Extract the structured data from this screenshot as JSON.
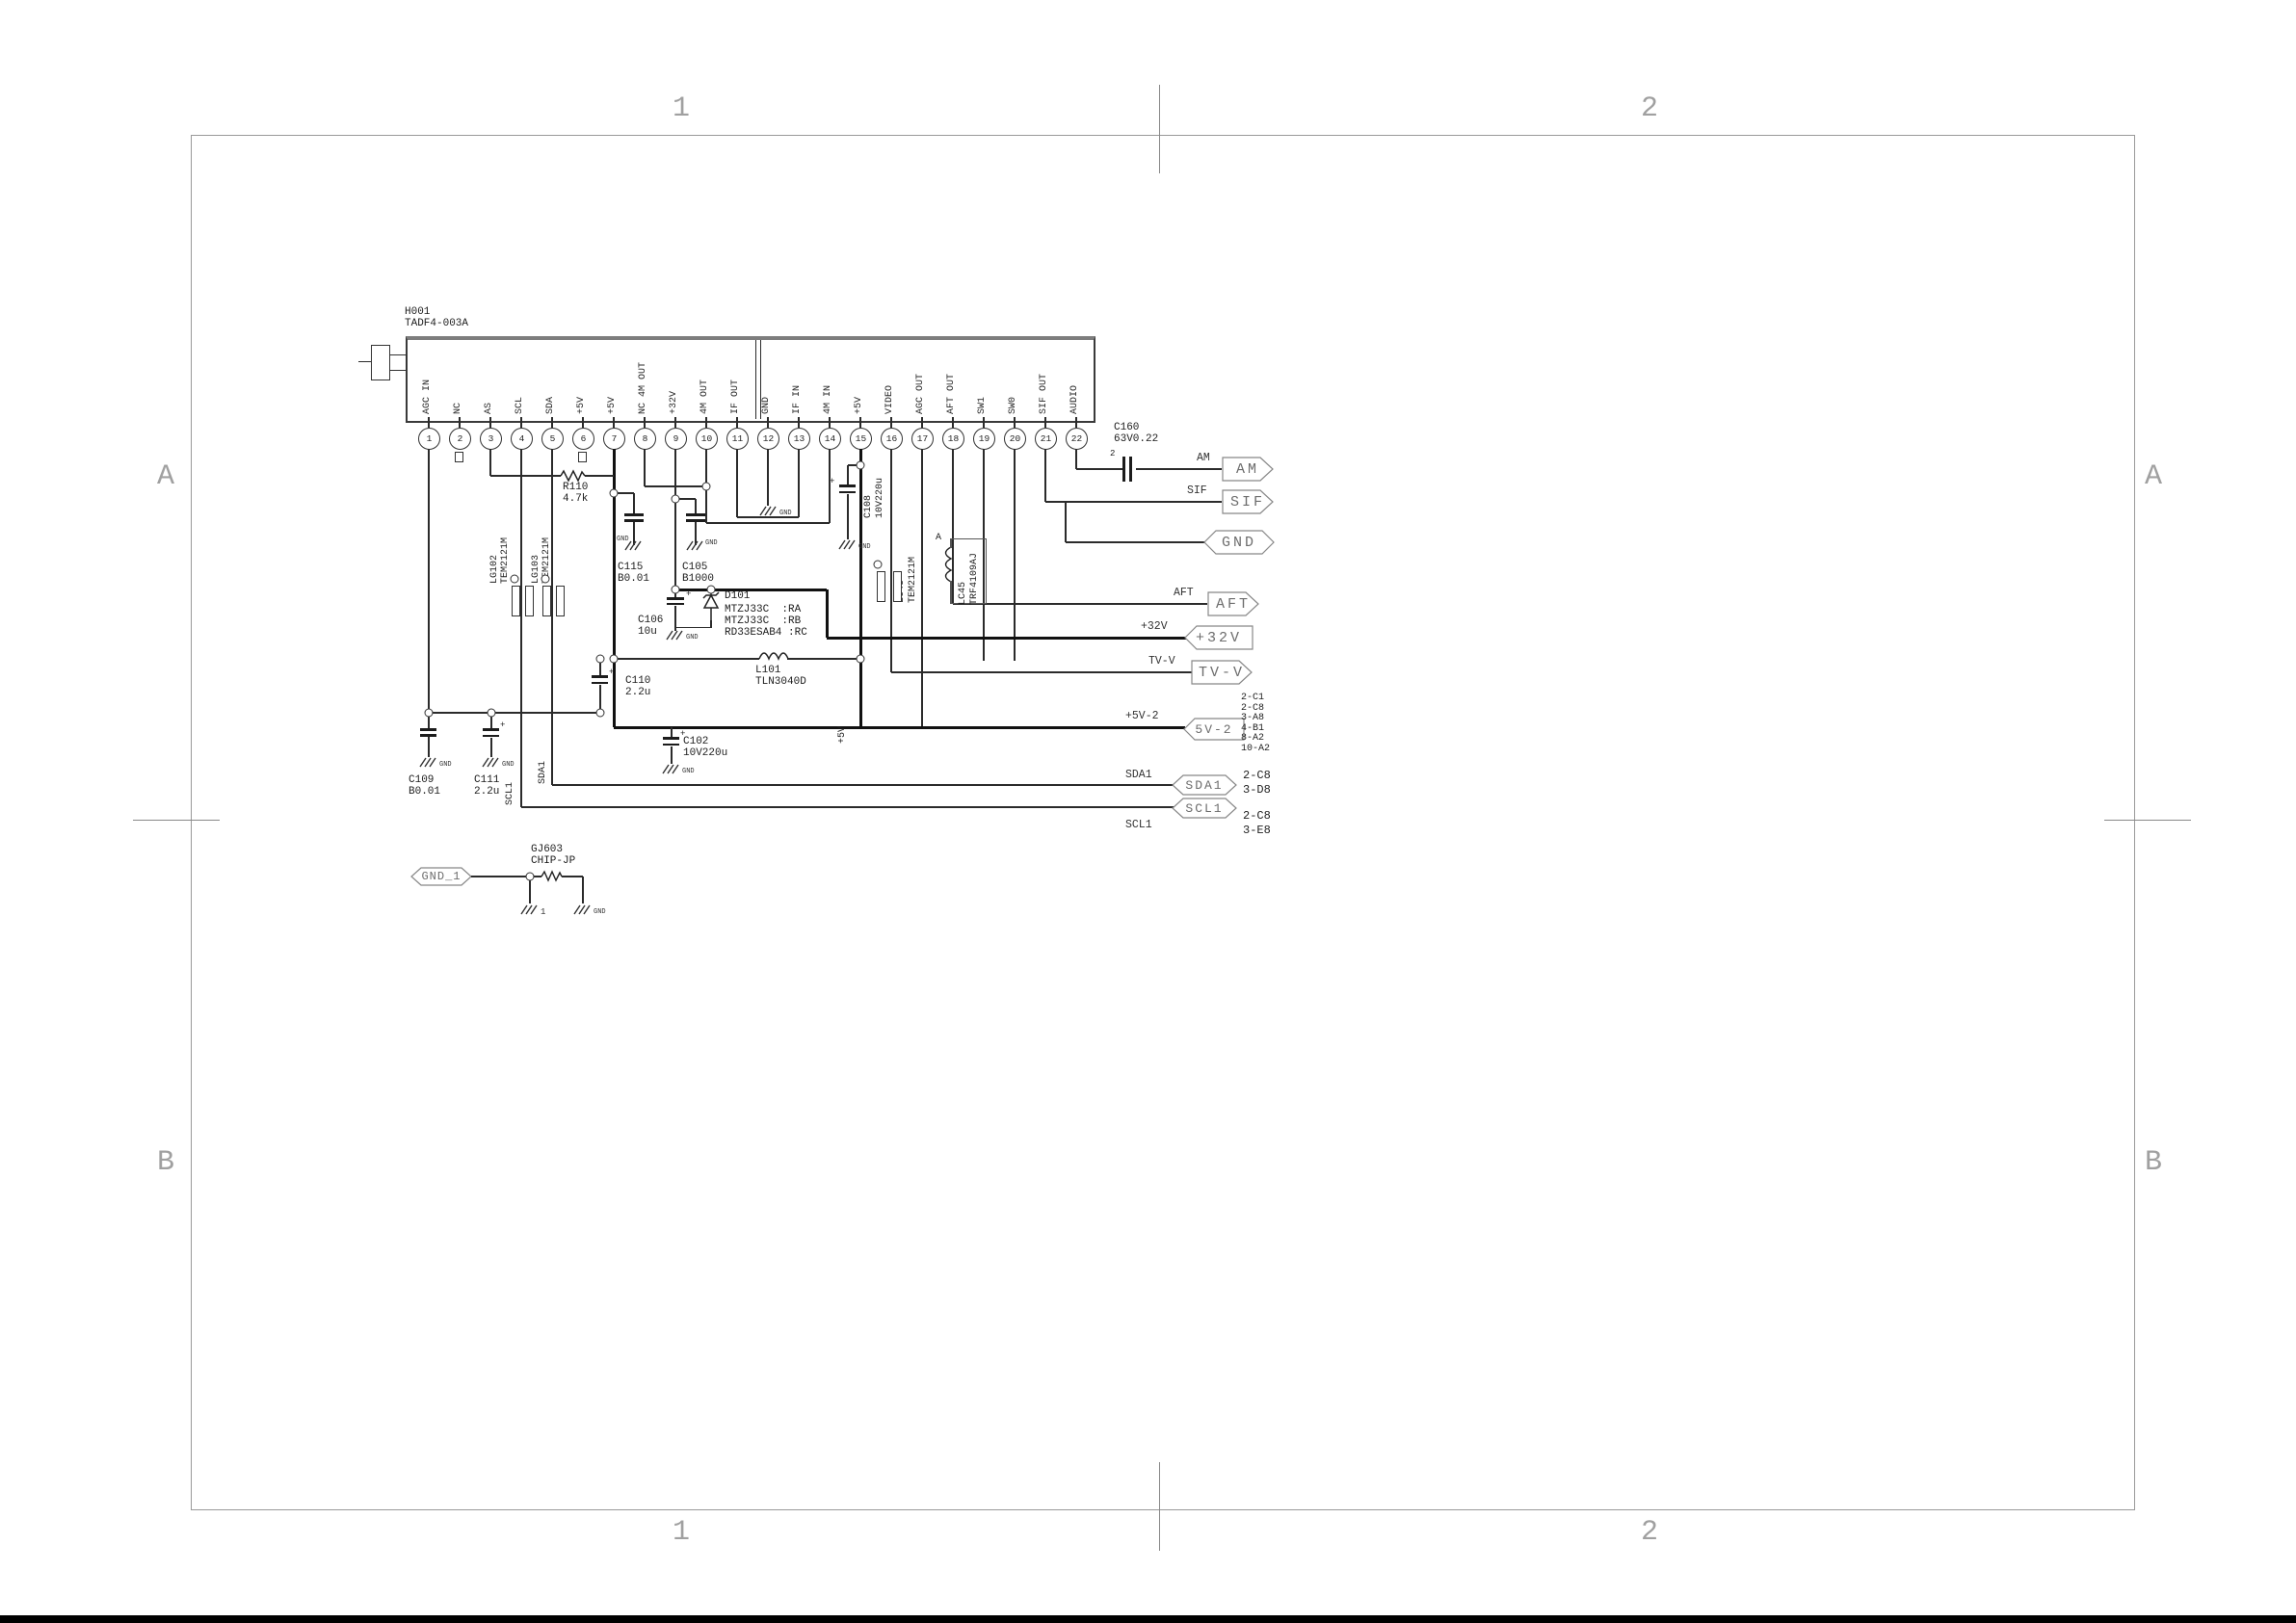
{
  "sheet": {
    "grid": {
      "top1": "1",
      "top2": "2",
      "bottom1": "1",
      "bottom2": "2",
      "leftA": "A",
      "leftB": "B",
      "rightA": "A",
      "rightB": "B"
    }
  },
  "ic": {
    "ref": "H001",
    "part": "TADF4-003A",
    "pins": [
      {
        "n": "1",
        "label": "AGC IN"
      },
      {
        "n": "2",
        "label": "NC"
      },
      {
        "n": "3",
        "label": "AS"
      },
      {
        "n": "4",
        "label": "SCL"
      },
      {
        "n": "5",
        "label": "SDA"
      },
      {
        "n": "6",
        "label": "+5V"
      },
      {
        "n": "7",
        "label": "+5V"
      },
      {
        "n": "8",
        "label": "NC 4M OUT"
      },
      {
        "n": "9",
        "label": "+32V"
      },
      {
        "n": "10",
        "label": "4M OUT"
      },
      {
        "n": "11",
        "label": "IF OUT"
      },
      {
        "n": "12",
        "label": "GND"
      },
      {
        "n": "13",
        "label": "IF IN"
      },
      {
        "n": "14",
        "label": "4M IN"
      },
      {
        "n": "15",
        "label": "+5V"
      },
      {
        "n": "16",
        "label": "VIDEO"
      },
      {
        "n": "17",
        "label": "AGC OUT"
      },
      {
        "n": "18",
        "label": "AFT OUT"
      },
      {
        "n": "19",
        "label": "SW1"
      },
      {
        "n": "20",
        "label": "SW0"
      },
      {
        "n": "21",
        "label": "SIF OUT"
      },
      {
        "n": "22",
        "label": "AUDIO"
      }
    ]
  },
  "components": {
    "r110": {
      "ref": "R110",
      "value": "4.7k"
    },
    "lg102": {
      "ref": "LG102",
      "value": "TEM2121M"
    },
    "lg103": {
      "ref": "LG103",
      "value": "TEM2121M"
    },
    "c115": {
      "ref": "C115",
      "value": "B0.01"
    },
    "c105": {
      "ref": "C105",
      "value": "B1000"
    },
    "c106": {
      "ref": "C106",
      "value": "10u"
    },
    "d101": {
      "ref": "D101",
      "lines": [
        "MTZJ33C  :RA",
        "MTZJ33C  :RB",
        "RD33ESAB4 :RC"
      ]
    },
    "c110": {
      "ref": "C110",
      "value": "2.2u"
    },
    "c109": {
      "ref": "C109",
      "value": "B0.01"
    },
    "c111": {
      "ref": "C111",
      "value": "2.2u"
    },
    "l101": {
      "ref": "L101",
      "value": "TLN3040D"
    },
    "c102": {
      "ref": "C102",
      "value": "10V220u"
    },
    "c108": {
      "ref": "C108",
      "value": "10V220u"
    },
    "lc43": {
      "ref": "LC43",
      "value": "TEM2121M"
    },
    "lc45": {
      "ref": "LC45",
      "value": "TRF4109AJ",
      "marker": "A"
    },
    "c160": {
      "ref": "C160",
      "value": "63V0.22",
      "marker": "2"
    },
    "gj603": {
      "ref": "GJ603",
      "value": "CHIP-JP"
    }
  },
  "net_labels": {
    "am": "AM",
    "sif": "SIF",
    "aft": "AFT",
    "p32v": "+32V",
    "tvv": "TV-V",
    "p5v2": "+5V-2",
    "sda1": "SDA1",
    "scl1": "SCL1",
    "sda1_wire": "SDA1",
    "scl1_wire": "SCL1",
    "p5v": "+5V"
  },
  "flags": {
    "am": "AM",
    "sif": "SIF",
    "gnd": "GND",
    "aft": "AFT",
    "p32v": "+32V",
    "tvv": "TV-V",
    "p5v2": "5V-2",
    "sda1": "SDA1",
    "scl1": "SCL1",
    "gnd1": "GND_1"
  },
  "refs": {
    "p5v2": "2-C1\n2-C8\n3-A8\n4-B1\n8-A2\n10-A2",
    "sda1": "2-C8\n3-D8",
    "scl1": "2-C8\n3-E8"
  },
  "symbols": {
    "gnd": "GND",
    "one": "1",
    "plus": "+"
  }
}
